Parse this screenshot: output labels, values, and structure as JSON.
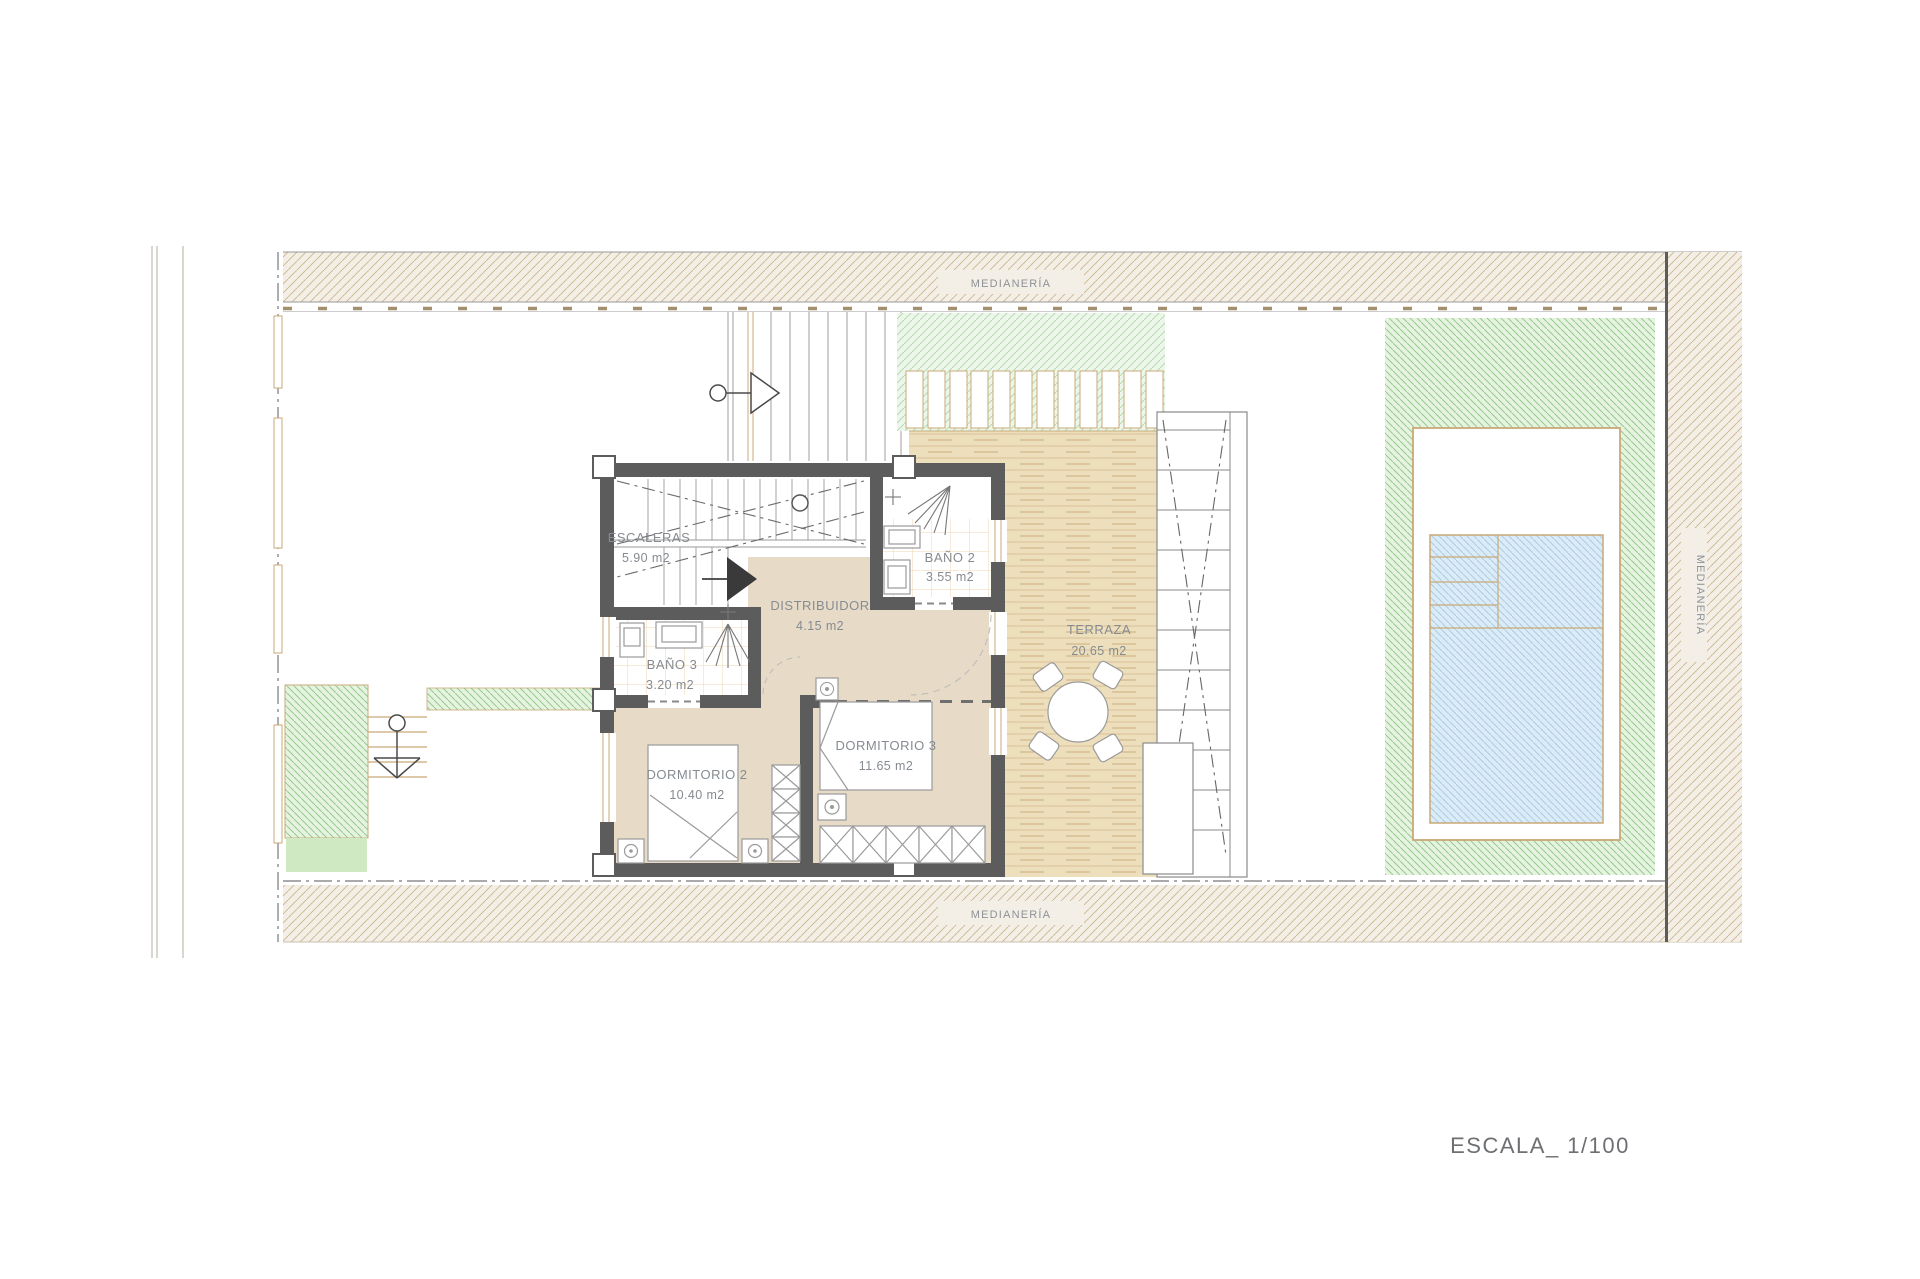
{
  "drawing": {
    "type": "floor-plan",
    "scale_label": "ESCALA_ 1/100"
  },
  "boundaries": {
    "medianeria_top": "MEDIANERÍA",
    "medianeria_bottom": "MEDIANERÍA",
    "medianeria_right": "MEDIANERÍA"
  },
  "rooms": {
    "escaleras": {
      "name": "ESCALERAS",
      "area": "5.90 m2"
    },
    "bano2": {
      "name": "BAÑO 2",
      "area": "3.55 m2"
    },
    "distribuidor": {
      "name": "DISTRIBUIDOR",
      "area": "4.15 m2"
    },
    "bano3": {
      "name": "BAÑO 3",
      "area": "3.20 m2"
    },
    "dormitorio2": {
      "name": "DORMITORIO 2",
      "area": "10.40 m2"
    },
    "dormitorio3": {
      "name": "DORMITORIO 3",
      "area": "11.65 m2"
    },
    "terraza": {
      "name": "TERRAZA",
      "area": "20.65 m2"
    }
  },
  "colors": {
    "wall": "#5c5c5c",
    "floor_tan": "#e7dbc8",
    "deck": "#eedfbc",
    "green_hatch": "#94ca8b",
    "pool_blue": "#dcecf7",
    "boundary_hatch": "#cdb58e",
    "label_gray": "#858b91"
  }
}
